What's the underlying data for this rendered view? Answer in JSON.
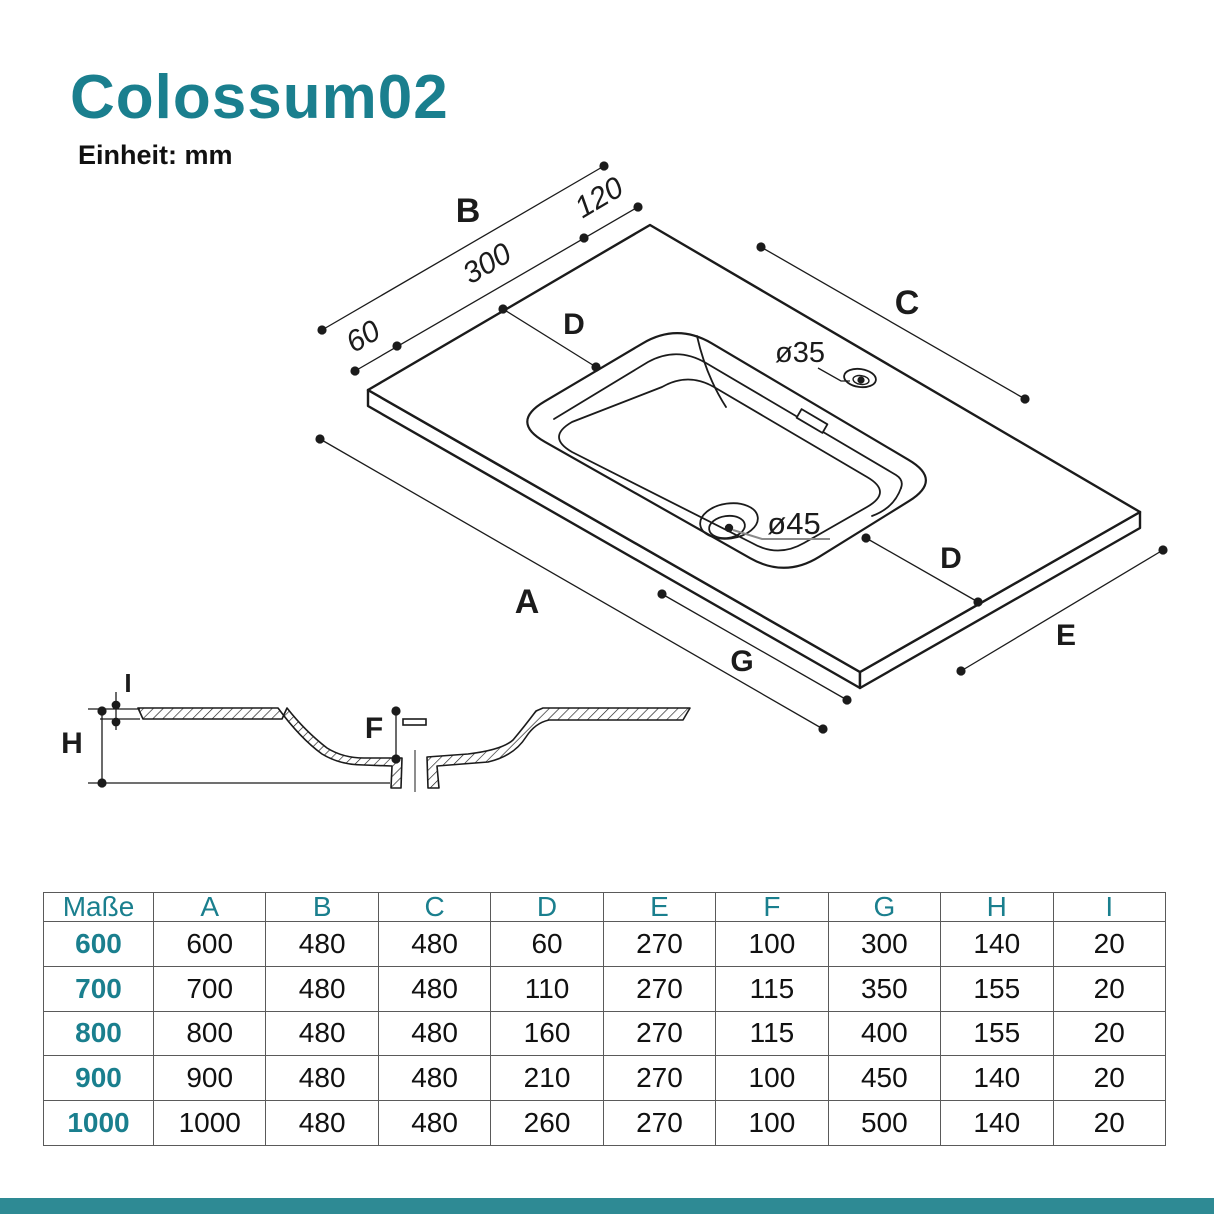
{
  "page": {
    "title": "Colossum02",
    "unit_label": "Einheit: mm",
    "accent_color": "#1a7f8e",
    "footer_bar_color": "#2e8a94"
  },
  "drawing": {
    "dim_labels": {
      "width_total": "B",
      "left_offset": "60",
      "mid_width": "300",
      "right_offset": "120",
      "deck_left": "D",
      "depth_right": "C",
      "faucet_hole": "ø35",
      "drain_hole": "ø45",
      "length_total": "A",
      "basin_length": "G",
      "deck_front": "D",
      "depth_front": "E",
      "rim_thickness": "I",
      "height_total": "H",
      "basin_depth": "F"
    }
  },
  "table": {
    "header": [
      "Maße",
      "A",
      "B",
      "C",
      "D",
      "E",
      "F",
      "G",
      "H",
      "I"
    ],
    "rows": [
      {
        "size": "600",
        "values": [
          "600",
          "480",
          "480",
          "60",
          "270",
          "100",
          "300",
          "140",
          "20"
        ]
      },
      {
        "size": "700",
        "values": [
          "700",
          "480",
          "480",
          "110",
          "270",
          "115",
          "350",
          "155",
          "20"
        ]
      },
      {
        "size": "800",
        "values": [
          "800",
          "480",
          "480",
          "160",
          "270",
          "115",
          "400",
          "155",
          "20"
        ]
      },
      {
        "size": "900",
        "values": [
          "900",
          "480",
          "480",
          "210",
          "270",
          "100",
          "450",
          "140",
          "20"
        ]
      },
      {
        "size": "1000",
        "values": [
          "1000",
          "480",
          "480",
          "260",
          "270",
          "100",
          "500",
          "140",
          "20"
        ]
      }
    ]
  }
}
